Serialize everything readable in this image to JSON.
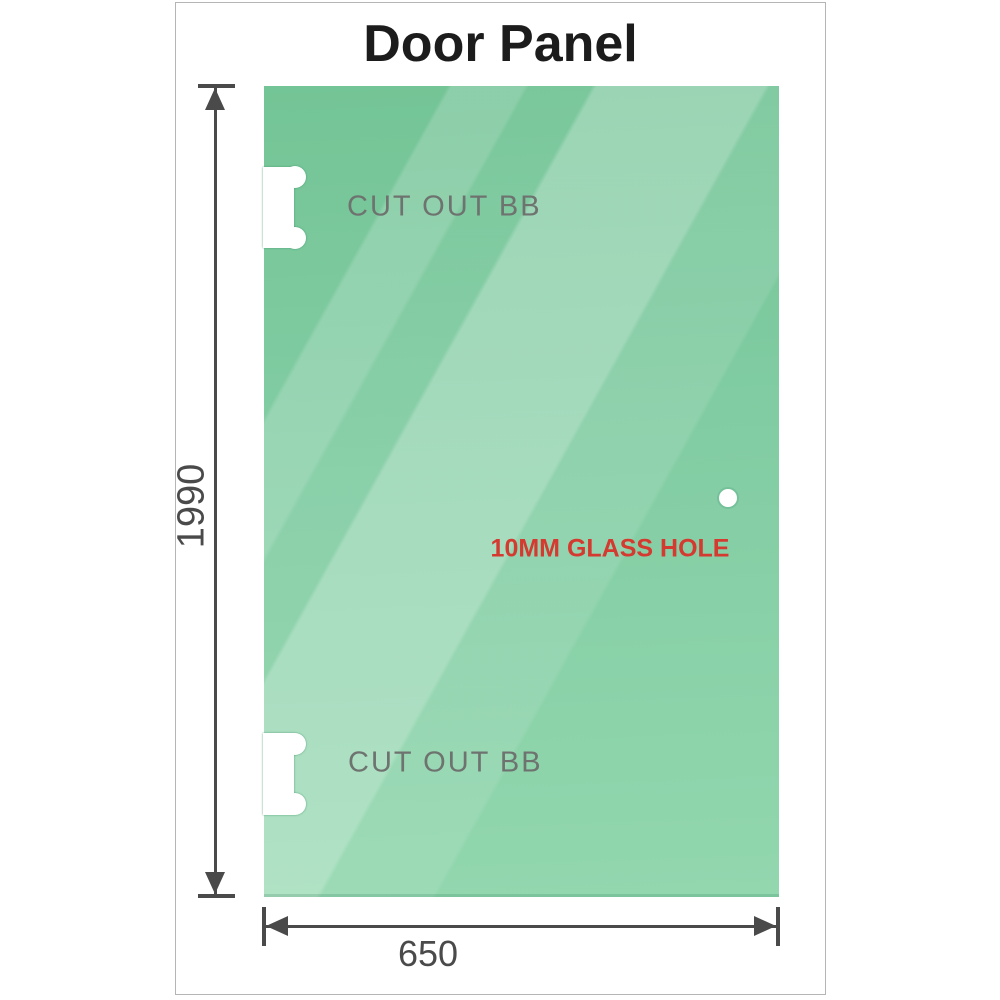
{
  "title": "Door Panel",
  "panel": {
    "cutouts": [
      {
        "label": "CUT OUT BB"
      },
      {
        "label": "CUT OUT BB"
      }
    ],
    "hole_label": "10MM GLASS HOLE"
  },
  "dimensions": {
    "height": "1990",
    "width": "650"
  },
  "colors": {
    "glass_top": "#73c496",
    "glass_bottom": "#92d7ae",
    "dimension": "#4a4a4a",
    "cutout_label": "#6e7370",
    "hole_label": "#d43a2f",
    "frame_border": "#b5b5b5",
    "title": "#1c1c1c"
  }
}
